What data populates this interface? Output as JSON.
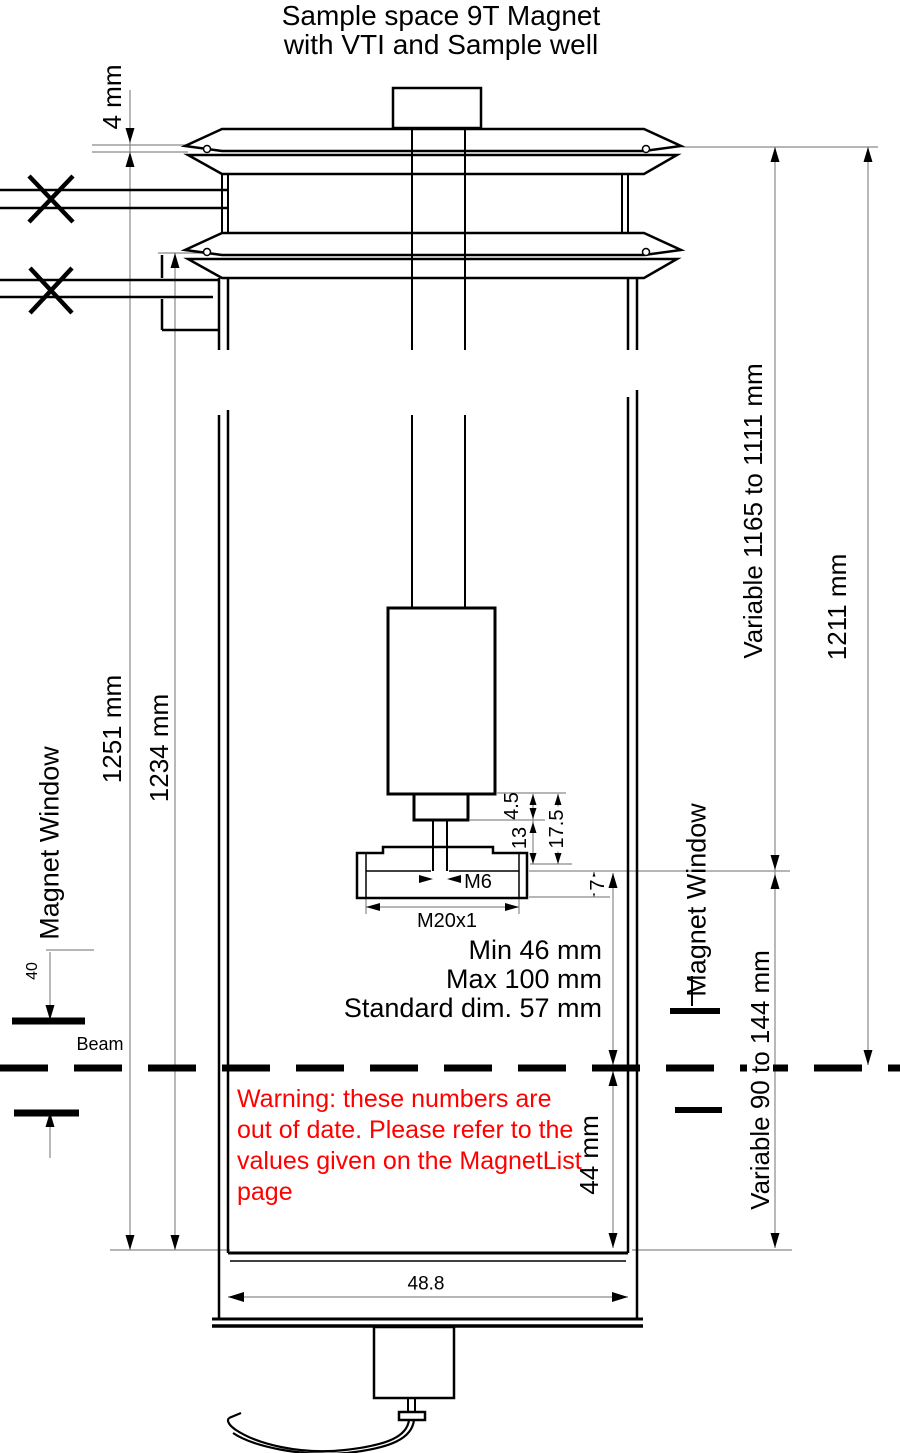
{
  "title": {
    "line1": "Sample space 9T Magnet",
    "line2": "with VTI and Sample well"
  },
  "dims": {
    "gap_top": "4 mm",
    "left_outer": "1251 mm",
    "left_inner": "1234 mm",
    "var_top": "Variable 1165 to 1111 mm",
    "right_total": "1211 mm",
    "var_bottom": "Variable 90 to 144 mm",
    "beam_to_bottom": "44 mm",
    "window_height": "40",
    "bore_width": "48.8",
    "step_a": "4.5",
    "step_b": "13",
    "step_total": "17.5",
    "rim": "7",
    "thread_small": "M6",
    "thread_large": "M20x1"
  },
  "sample_space": {
    "min": "Min 46 mm",
    "max": "Max 100 mm",
    "standard": "Standard dim. 57 mm"
  },
  "labels": {
    "magnet_window_left": "Magnet Window",
    "magnet_window_right": "Magnet Window",
    "beam": "Beam"
  },
  "warning": {
    "color": "#ff0000",
    "lines": [
      "Warning: these numbers are",
      "out of date. Please refer to the",
      "values given on the MagnetList",
      "page"
    ]
  }
}
